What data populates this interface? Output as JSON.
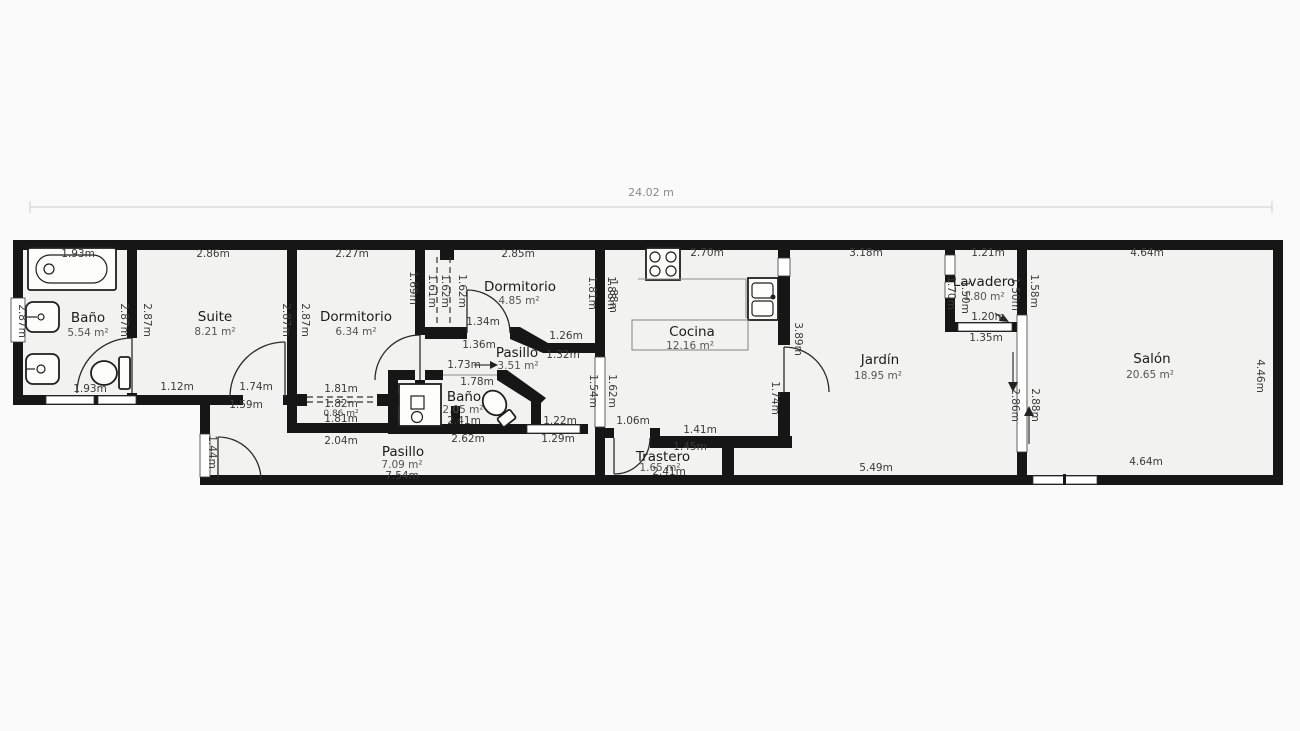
{
  "page": {
    "total_width_label": "24.02 m"
  },
  "rooms": {
    "bano1": {
      "name": "Baño",
      "area": "5.54 m²"
    },
    "suite": {
      "name": "Suite",
      "area": "8.21 m²"
    },
    "dorm1": {
      "name": "Dormitorio",
      "area": "6.34 m²"
    },
    "dorm2": {
      "name": "Dormitorio",
      "area": "4.85 m²"
    },
    "pasillo1": {
      "name": "Pasillo",
      "area": "3.51 m²"
    },
    "bano2": {
      "name": "Baño",
      "area": "2.05 m²",
      "length": "2.41m"
    },
    "pasillo2": {
      "name": "Pasillo",
      "area": "7.09 m²",
      "length": "7.54m"
    },
    "trastero": {
      "name": "Trastero",
      "area": "1.65 m²",
      "length": "2.41m"
    },
    "cocina": {
      "name": "Cocina",
      "area": "12.16 m²"
    },
    "jardin": {
      "name": "Jardín",
      "area": "18.95 m²"
    },
    "lavadero": {
      "name": "Lavadero",
      "area": "1.80 m²"
    },
    "salon": {
      "name": "Salón",
      "area": "20.65 m²"
    }
  },
  "dims": {
    "tub_width": "1.93m",
    "bano1_window": "2.87m",
    "bano1_wall_left": "2.87m",
    "bano1_wall_right": "2.87m",
    "bano1_bottom": "1.93m",
    "suite_top": "2.86m",
    "suite_wall_left": "2.87m",
    "suite_wall_right": "2.87m",
    "suite_bottom_a": "1.12m",
    "suite_bottom_b": "1.74m",
    "suite_door": "1.59m",
    "dorm1_top": "2.27m",
    "dorm1_right": "1.69m",
    "wardrobe_a": "1.81m",
    "wardrobe_b": "1.82m",
    "wardrobe_area": "0.86 m²",
    "wardrobe_c": "1.81m",
    "pasillo2_top": "2.04m",
    "closet_a": "1.61m",
    "closet_b": "1.62m",
    "closet_c": "1.62m",
    "dorm2_top": "2.85m",
    "dorm2_door_a": "1.34m",
    "dorm2_door_b": "1.36m",
    "dorm2_right_a": "1.81m",
    "dorm2_right_b": "1.88m",
    "pasillo1_a": "1.26m",
    "pasillo1_b": "1.32m",
    "bano2_door": "1.73m",
    "bano2_top": "1.78m",
    "bano2_bottom": "2.62m",
    "window1_a": "1.22m",
    "window1_b": "1.29m",
    "window2_a": "1.54m",
    "window2_b": "1.62m",
    "pasillo2_door": "1.44m",
    "cocina_top": "2.70m",
    "cocina_left": "1.88m",
    "cocina_bottom_a": "1.06m",
    "cocina_bottom_b": "1.41m",
    "cocina_right_a": "3.89m",
    "cocina_right_b": "1.74m",
    "trastero_top": "1.45m",
    "jardin_top": "3.18m",
    "jardin_bottom": "5.49m",
    "jardin_right": "2.86m",
    "salon_left_a": "1.58m",
    "salon_left_b": "2.88m",
    "lav_top": "1.21m",
    "lav_left_a": "1.70m",
    "lav_left_b": "1.50m",
    "lav_right": "1.50m",
    "lav_bottom_a": "1.20m",
    "lav_bottom_b": "1.35m",
    "salon_top": "4.64m",
    "salon_right": "4.46m",
    "salon_bottom": "4.64m"
  }
}
